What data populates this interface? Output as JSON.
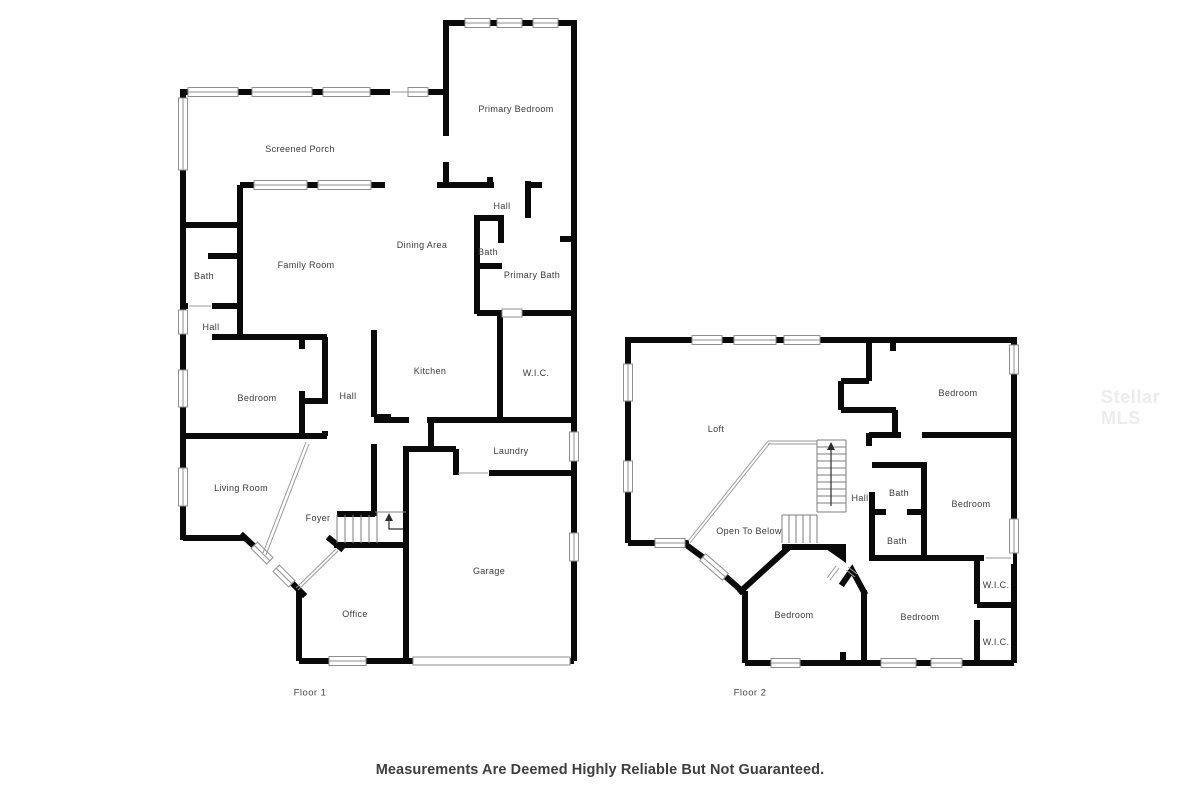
{
  "floor1": {
    "name": "Floor 1",
    "rooms": [
      {
        "label": "Screened Porch"
      },
      {
        "label": "Primary Bedroom"
      },
      {
        "label": "Hall"
      },
      {
        "label": "Dining Area"
      },
      {
        "label": "Bath"
      },
      {
        "label": "Primary Bath"
      },
      {
        "label": "Family Room"
      },
      {
        "label": "Bath"
      },
      {
        "label": "Hall"
      },
      {
        "label": "Bedroom"
      },
      {
        "label": "Kitchen"
      },
      {
        "label": "Hall"
      },
      {
        "label": "W.I.C."
      },
      {
        "label": "Laundry"
      },
      {
        "label": "Living Room"
      },
      {
        "label": "Foyer"
      },
      {
        "label": "Garage"
      },
      {
        "label": "Office"
      }
    ]
  },
  "floor2": {
    "name": "Floor 2",
    "rooms": [
      {
        "label": "Loft"
      },
      {
        "label": "Bedroom"
      },
      {
        "label": "Hall"
      },
      {
        "label": "Bath"
      },
      {
        "label": "Bedroom"
      },
      {
        "label": "Bath"
      },
      {
        "label": "Open To Below"
      },
      {
        "label": "W.I.C."
      },
      {
        "label": "Bedroom"
      },
      {
        "label": "Bedroom"
      },
      {
        "label": "W.I.C."
      }
    ]
  },
  "footer": {
    "disclaimer": "Measurements Are Deemed Highly Reliable But Not Guaranteed."
  },
  "watermark": {
    "text": "Stellar MLS"
  },
  "colors": {
    "wall": "#0a0a0a",
    "window_frame": "#8f8f8f",
    "label_text": "#3a3a3a",
    "watermark_text": "#ececec"
  }
}
